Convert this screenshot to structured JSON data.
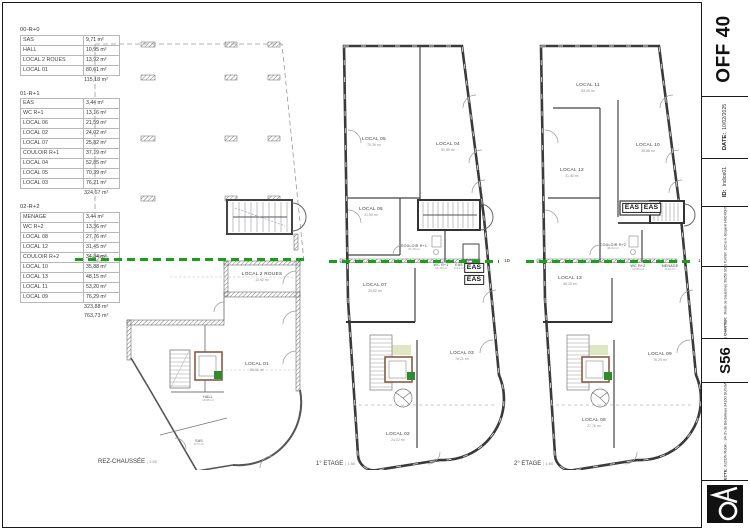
{
  "tables": [
    {
      "title": "00-R+0",
      "rows": [
        [
          "SAS",
          "9,71 m²"
        ],
        [
          "HALL",
          "10,95 m²"
        ],
        [
          "LOCAL 2 ROUES",
          "13,92 m²"
        ],
        [
          "LOCAL 01",
          "80,61 m²"
        ]
      ],
      "totals": [
        "115,18 m²"
      ]
    },
    {
      "title": "01-R+1",
      "rows": [
        [
          "EAS",
          "3,44 m²"
        ],
        [
          "WC R+1",
          "13,16 m²"
        ],
        [
          "LOCAL 06",
          "21,59 m²"
        ],
        [
          "LOCAL 02",
          "24,02 m²"
        ],
        [
          "LOCAL 07",
          "25,82 m²"
        ],
        [
          "COULOIR R+1",
          "37,19 m²"
        ],
        [
          "LOCAL 04",
          "52,85 m²"
        ],
        [
          "LOCAL 05",
          "70,39 m²"
        ],
        [
          "LOCAL 03",
          "76,21 m²"
        ]
      ],
      "totals": [
        "324,67 m²"
      ]
    },
    {
      "title": "02-R+2",
      "rows": [
        [
          "MENAGE",
          "3,44 m²"
        ],
        [
          "WC R+2",
          "13,36 m²"
        ],
        [
          "LOCAL 08",
          "27,76 m²"
        ],
        [
          "LOCAL 12",
          "31,45 m²"
        ],
        [
          "COULOIR R+2",
          "34,34 m²"
        ],
        [
          "LOCAL 10",
          "35,88 m²"
        ],
        [
          "LOCAL 13",
          "48,15 m²"
        ],
        [
          "LOCAL 11",
          "53,20 m²"
        ],
        [
          "LOCAL 09",
          "76,29 m²"
        ]
      ],
      "totals": [
        "323,88 m²",
        "763,73 m²"
      ]
    }
  ],
  "plans": [
    {
      "caption": "REZ-CHAUSSÉE",
      "scale": "1:50",
      "section_label": "",
      "rooms": [
        {
          "name": "LOCAL 2 ROUES",
          "area": "13,92 m²",
          "x": 262,
          "y": 277
        },
        {
          "name": "LOCAL 01",
          "area": "80,61 m²",
          "x": 257,
          "y": 367
        },
        {
          "name": "HALL",
          "area": "10,95 m²",
          "x": 208,
          "y": 399,
          "cls": "tiny"
        },
        {
          "name": "SAS",
          "area": "9,71 m²",
          "x": 199,
          "y": 443,
          "cls": "tiny"
        }
      ]
    },
    {
      "caption": "1° ETAGE",
      "scale": "1:50",
      "section_label": "1D",
      "rooms": [
        {
          "name": "LOCAL 05",
          "area": "70,39 m²",
          "x": 374,
          "y": 142
        },
        {
          "name": "LOCAL 04",
          "area": "52,85 m²",
          "x": 448,
          "y": 147
        },
        {
          "name": "LOCAL 06",
          "area": "21,59 m²",
          "x": 371,
          "y": 212
        },
        {
          "name": "COULOIR R+1",
          "area": "37,19 m²",
          "x": 414,
          "y": 248,
          "cls": "tiny"
        },
        {
          "name": "WC R+1",
          "area": "13,16 m²",
          "x": 441,
          "y": 267,
          "cls": "tiny"
        },
        {
          "name": "EAS",
          "area": "3,44 m²",
          "x": 459,
          "y": 267,
          "cls": "tiny"
        },
        {
          "name": "EAS",
          "x": 474,
          "y": 268,
          "cls": "eas"
        },
        {
          "name": "EAS",
          "x": 474,
          "y": 280,
          "cls": "eas"
        },
        {
          "name": "LOCAL 07",
          "area": "25,82 m²",
          "x": 375,
          "y": 288
        },
        {
          "name": "LOCAL 03",
          "area": "76,21 m²",
          "x": 462,
          "y": 356
        },
        {
          "name": "LOCAL 02",
          "area": "24,02 m²",
          "x": 398,
          "y": 437
        }
      ]
    },
    {
      "caption": "2° ETAGE",
      "scale": "1:50",
      "section_label": "1D",
      "rooms": [
        {
          "name": "LOCAL 11",
          "area": "53,20 m²",
          "x": 588,
          "y": 88
        },
        {
          "name": "LOCAL 10",
          "area": "35,88 m²",
          "x": 648,
          "y": 148
        },
        {
          "name": "LOCAL 12",
          "area": "31,45 m²",
          "x": 572,
          "y": 173
        },
        {
          "name": "EAS",
          "x": 632,
          "y": 208,
          "cls": "eas"
        },
        {
          "name": "EAS",
          "x": 651,
          "y": 208,
          "cls": "eas"
        },
        {
          "name": "COULOIR R+2",
          "area": "34,34 m²",
          "x": 613,
          "y": 247,
          "cls": "tiny"
        },
        {
          "name": "WC R+2",
          "area": "13,36 m²",
          "x": 638,
          "y": 268,
          "cls": "tiny"
        },
        {
          "name": "MENAGE",
          "area": "3,44 m²",
          "x": 670,
          "y": 268,
          "cls": "tiny"
        },
        {
          "name": "LOCAL 13",
          "area": "48,15 m²",
          "x": 570,
          "y": 281
        },
        {
          "name": "LOCAL 09",
          "area": "76,29 m²",
          "x": 660,
          "y": 357
        },
        {
          "name": "LOCAL 08",
          "area": "27,76 m²",
          "x": 594,
          "y": 423
        }
      ]
    }
  ],
  "titleblock": {
    "sheet_code": "OFF 40",
    "date_label": "DATE:",
    "date_value": "10/02/2025",
    "id_label": "ID:",
    "id_value": "Indice01",
    "moa_label": "MOA:",
    "moa_name": "SAS PLAYER",
    "moa_address": "1015 av H. Becquerel 34000 MONTPELLIER",
    "site_label": "ADRESSE CHANTIER:",
    "site_address": "Route de Saussines 30250 SOMMIERES",
    "project_code": "S56",
    "architect_label": "ARCHITECTE:",
    "architect_name": "JUZON Robin",
    "architect_address": "34 ch de Bédarieux 34160 SUSSARGUES"
  },
  "colors": {
    "section_line": "#18a018",
    "elevator_badge": "#2e8b2e"
  }
}
